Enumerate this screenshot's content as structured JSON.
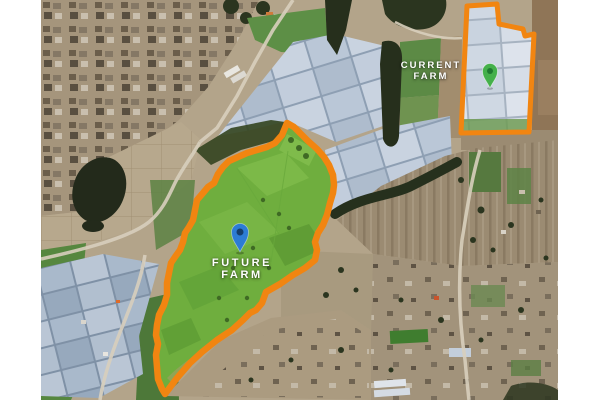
{
  "map": {
    "kind": "satellite-map",
    "page_background": "#ffffff",
    "annotations": {
      "current_farm": {
        "label": "CURRENT\nFARM",
        "pin": {
          "icon": "map-pin-icon",
          "color": "#44b04a",
          "inner_color": "#1f7a30"
        },
        "outline_color": "#f18511"
      },
      "future_farm": {
        "label": "FUTURE\nFARM",
        "pin": {
          "icon": "map-pin-icon",
          "color": "#2c7cd5",
          "inner_color": "#153e6d"
        },
        "outline_color": "#f18511",
        "highlight_fill": "#6fae3e"
      }
    },
    "terrain_colors": {
      "field_tan": "#b3a48a",
      "village": "#a5957c",
      "greenhouse_roof": "#bfcbda",
      "vegetation_dark": "#262f1c",
      "road": "#d8cfbd",
      "crop_green": "#5c8a45"
    }
  }
}
